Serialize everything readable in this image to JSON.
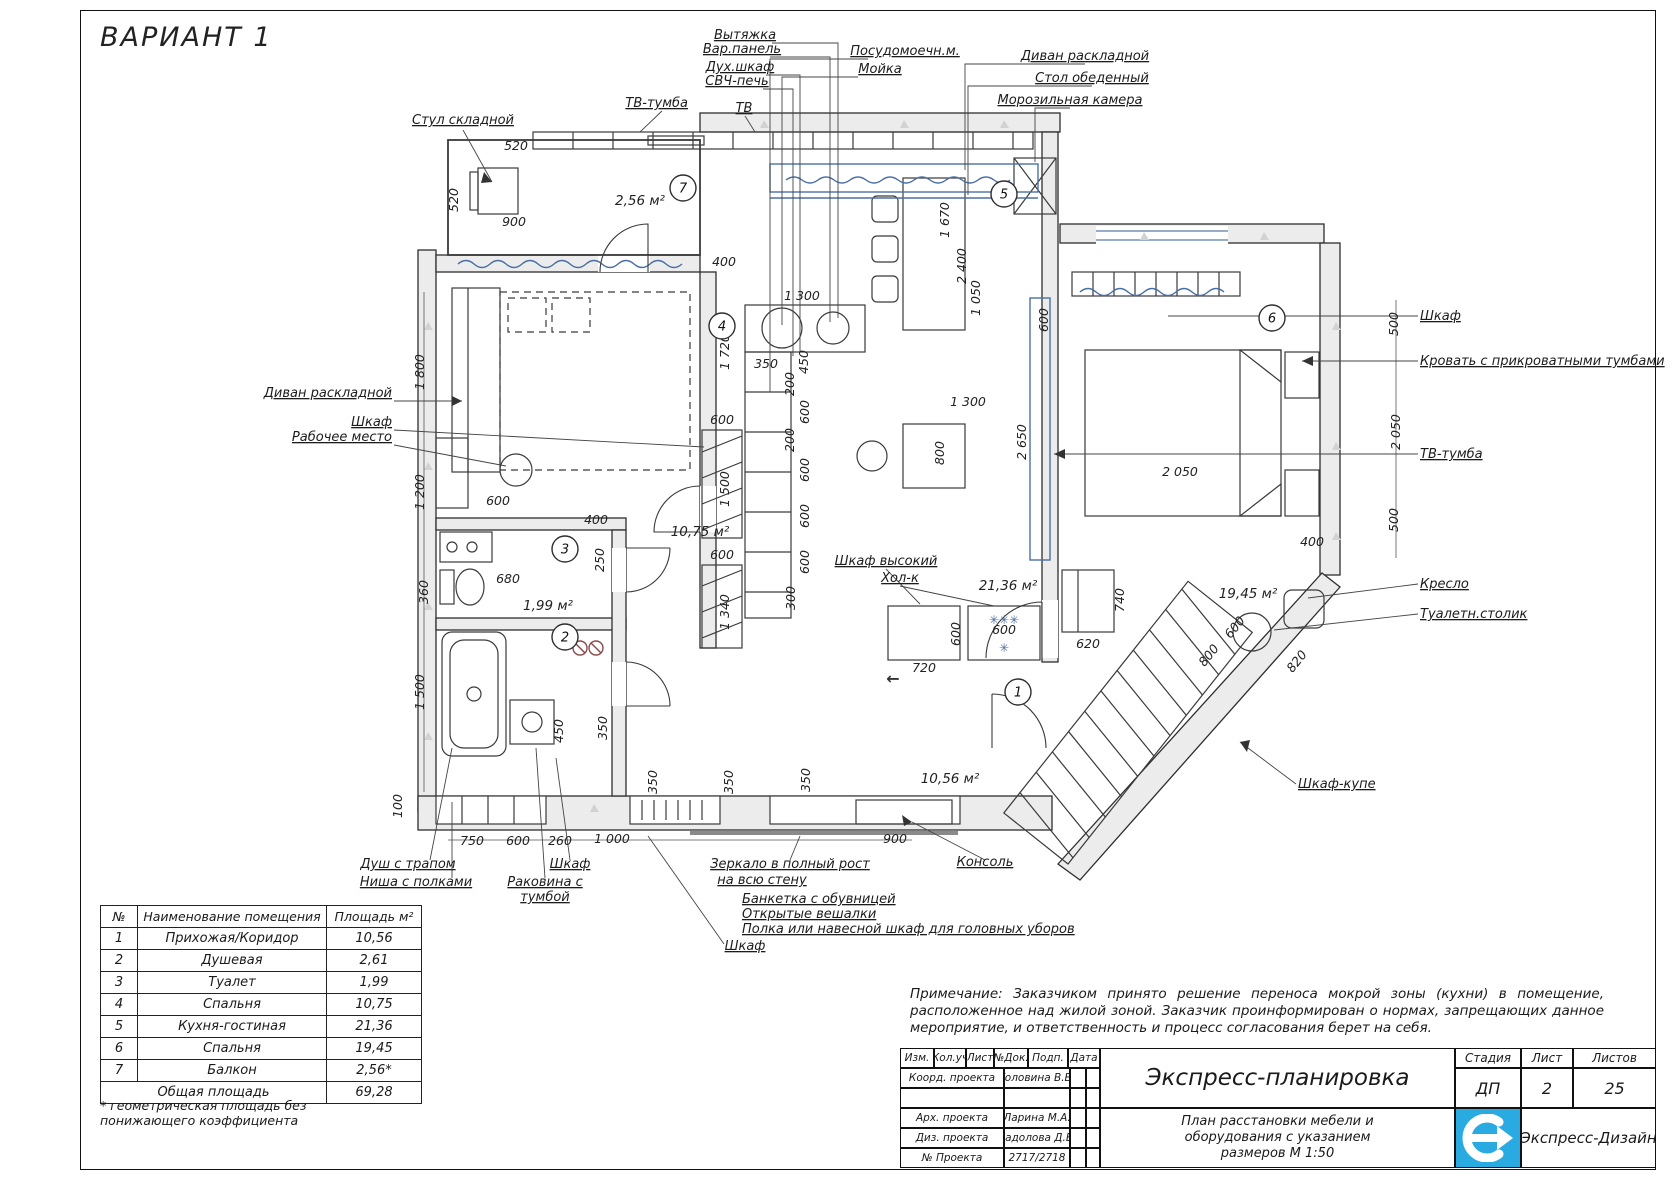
{
  "sheet": {
    "variant_title": "ВАРИАНТ 1"
  },
  "plan": {
    "callouts": [
      {
        "t": "Стул складной",
        "x": 463,
        "y": 124,
        "a": "m"
      },
      {
        "t": "ТВ-тумба",
        "x": 688,
        "y": 107,
        "a": "e"
      },
      {
        "t": "ТВ",
        "x": 744,
        "y": 112,
        "a": "m"
      },
      {
        "t": "Вытяжка",
        "x": 745,
        "y": 39,
        "a": "m"
      },
      {
        "t": "Вар.панель",
        "x": 742,
        "y": 53,
        "a": "m"
      },
      {
        "t": "Дух.шкаф",
        "x": 740,
        "y": 71,
        "a": "m"
      },
      {
        "t": "СВЧ-печь",
        "x": 737,
        "y": 85,
        "a": "m"
      },
      {
        "t": "Посудомоечн.м.",
        "x": 905,
        "y": 55,
        "a": "m"
      },
      {
        "t": "Мойка",
        "x": 880,
        "y": 73,
        "a": "m"
      },
      {
        "t": "Диван раскладной",
        "x": 1085,
        "y": 60,
        "a": "m"
      },
      {
        "t": "Стол обеденный",
        "x": 1092,
        "y": 82,
        "a": "m"
      },
      {
        "t": "Морозильная камера",
        "x": 1070,
        "y": 104,
        "a": "m"
      },
      {
        "t": "Диван раскладной",
        "x": 392,
        "y": 397,
        "a": "e"
      },
      {
        "t": "Шкаф",
        "x": 392,
        "y": 426,
        "a": "e"
      },
      {
        "t": "Рабочее место",
        "x": 392,
        "y": 441,
        "a": "e"
      },
      {
        "t": "Шкаф высокий",
        "x": 886,
        "y": 565,
        "a": "m"
      },
      {
        "t": "Хол-к",
        "x": 900,
        "y": 582,
        "a": "m"
      },
      {
        "t": "Шкаф",
        "x": 1420,
        "y": 320,
        "a": "s"
      },
      {
        "t": "Кровать с прикроватными тумбами",
        "x": 1420,
        "y": 365,
        "a": "s"
      },
      {
        "t": "ТВ-тумба",
        "x": 1420,
        "y": 458,
        "a": "s"
      },
      {
        "t": "Кресло",
        "x": 1420,
        "y": 588,
        "a": "s"
      },
      {
        "t": "Туалетн.столик",
        "x": 1420,
        "y": 618,
        "a": "s"
      },
      {
        "t": "Шкаф-купе",
        "x": 1298,
        "y": 788,
        "a": "s"
      },
      {
        "t": "Душ с трапом",
        "x": 408,
        "y": 868,
        "a": "m"
      },
      {
        "t": "Ниша с полками",
        "x": 416,
        "y": 886,
        "a": "m"
      },
      {
        "t": "Шкаф",
        "x": 570,
        "y": 868,
        "a": "m"
      },
      {
        "t": "Раковина с",
        "x": 545,
        "y": 886,
        "a": "m"
      },
      {
        "t": "тумбой",
        "x": 545,
        "y": 901,
        "a": "m"
      },
      {
        "t": "Зеркало в полный рост",
        "x": 790,
        "y": 868,
        "a": "m"
      },
      {
        "t": "на всю стену",
        "x": 762,
        "y": 884,
        "a": "m"
      },
      {
        "t": "Банкетка с обувницей",
        "x": 742,
        "y": 903,
        "a": "s"
      },
      {
        "t": "Открытые вешалки",
        "x": 742,
        "y": 918,
        "a": "s"
      },
      {
        "t": "Полка или навесной шкаф для головных уборов",
        "x": 742,
        "y": 933,
        "a": "s"
      },
      {
        "t": "Шкаф",
        "x": 745,
        "y": 950,
        "a": "m"
      },
      {
        "t": "Консоль",
        "x": 985,
        "y": 866,
        "a": "m"
      }
    ],
    "dims": [
      {
        "t": "520",
        "x": 516,
        "y": 150,
        "r": 0
      },
      {
        "t": "520",
        "x": 458,
        "y": 200,
        "r": -90
      },
      {
        "t": "900",
        "x": 514,
        "y": 226,
        "r": 0
      },
      {
        "t": "1 800",
        "x": 424,
        "y": 372,
        "r": -90
      },
      {
        "t": "1 200",
        "x": 424,
        "y": 492,
        "r": -90
      },
      {
        "t": "360",
        "x": 428,
        "y": 592,
        "r": -90
      },
      {
        "t": "1 500",
        "x": 424,
        "y": 692,
        "r": -90
      },
      {
        "t": "100",
        "x": 402,
        "y": 806,
        "r": -90
      },
      {
        "t": "600",
        "x": 498,
        "y": 505,
        "r": 0
      },
      {
        "t": "400",
        "x": 596,
        "y": 524,
        "r": 0
      },
      {
        "t": "680",
        "x": 508,
        "y": 583,
        "r": 0
      },
      {
        "t": "250",
        "x": 604,
        "y": 560,
        "r": -90
      },
      {
        "t": "450",
        "x": 563,
        "y": 731,
        "r": -90
      },
      {
        "t": "350",
        "x": 607,
        "y": 728,
        "r": -90
      },
      {
        "t": "400",
        "x": 724,
        "y": 266,
        "r": 0
      },
      {
        "t": "1 720",
        "x": 729,
        "y": 352,
        "r": -90
      },
      {
        "t": "1 300",
        "x": 802,
        "y": 300,
        "r": 0
      },
      {
        "t": "350",
        "x": 766,
        "y": 368,
        "r": 0
      },
      {
        "t": "450",
        "x": 808,
        "y": 362,
        "r": -90
      },
      {
        "t": "200",
        "x": 794,
        "y": 384,
        "r": -90
      },
      {
        "t": "600",
        "x": 809,
        "y": 412,
        "r": -90
      },
      {
        "t": "200",
        "x": 794,
        "y": 440,
        "r": -90
      },
      {
        "t": "600",
        "x": 809,
        "y": 470,
        "r": -90
      },
      {
        "t": "600",
        "x": 809,
        "y": 516,
        "r": -90
      },
      {
        "t": "600",
        "x": 809,
        "y": 562,
        "r": -90
      },
      {
        "t": "300",
        "x": 795,
        "y": 598,
        "r": -90
      },
      {
        "t": "600",
        "x": 722,
        "y": 424,
        "r": 0
      },
      {
        "t": "1 500",
        "x": 729,
        "y": 489,
        "r": -90
      },
      {
        "t": "600",
        "x": 722,
        "y": 559,
        "r": 0
      },
      {
        "t": "1 340",
        "x": 729,
        "y": 612,
        "r": -90
      },
      {
        "t": "1 670",
        "x": 949,
        "y": 220,
        "r": -90
      },
      {
        "t": "2 400",
        "x": 966,
        "y": 266,
        "r": -90
      },
      {
        "t": "1 050",
        "x": 980,
        "y": 298,
        "r": -90
      },
      {
        "t": "1 300",
        "x": 968,
        "y": 406,
        "r": 0
      },
      {
        "t": "800",
        "x": 944,
        "y": 453,
        "r": -90
      },
      {
        "t": "720",
        "x": 924,
        "y": 672,
        "r": 0
      },
      {
        "t": "600",
        "x": 1004,
        "y": 634,
        "r": 0
      },
      {
        "t": "600",
        "x": 960,
        "y": 634,
        "r": -90
      },
      {
        "t": "620",
        "x": 1088,
        "y": 648,
        "r": 0
      },
      {
        "t": "740",
        "x": 1124,
        "y": 600,
        "r": -90
      },
      {
        "t": "600",
        "x": 1048,
        "y": 320,
        "r": -90
      },
      {
        "t": "2 650",
        "x": 1026,
        "y": 442,
        "r": -90
      },
      {
        "t": "2 050",
        "x": 1180,
        "y": 476,
        "r": 0
      },
      {
        "t": "500",
        "x": 1398,
        "y": 324,
        "r": -90
      },
      {
        "t": "2 050",
        "x": 1400,
        "y": 432,
        "r": -90
      },
      {
        "t": "500",
        "x": 1398,
        "y": 520,
        "r": -90
      },
      {
        "t": "400",
        "x": 1312,
        "y": 546,
        "r": 0
      },
      {
        "t": "600",
        "x": 1238,
        "y": 630,
        "r": -51
      },
      {
        "t": "800",
        "x": 1212,
        "y": 658,
        "r": -51
      },
      {
        "t": "820",
        "x": 1300,
        "y": 664,
        "r": -51
      },
      {
        "t": "750",
        "x": 472,
        "y": 845,
        "r": 0
      },
      {
        "t": "600",
        "x": 518,
        "y": 845,
        "r": 0
      },
      {
        "t": "260",
        "x": 560,
        "y": 845,
        "r": 0
      },
      {
        "t": "1 000",
        "x": 612,
        "y": 843,
        "r": 0
      },
      {
        "t": "900",
        "x": 895,
        "y": 843,
        "r": 0
      },
      {
        "t": "350",
        "x": 657,
        "y": 782,
        "r": -90
      },
      {
        "t": "350",
        "x": 733,
        "y": 782,
        "r": -90
      },
      {
        "t": "350",
        "x": 810,
        "y": 780,
        "r": -90
      }
    ],
    "areas": [
      {
        "t": "2,56 м²",
        "x": 640,
        "y": 205
      },
      {
        "t": "10,75 м²",
        "x": 700,
        "y": 536
      },
      {
        "t": "1,99 м²",
        "x": 548,
        "y": 610
      },
      {
        "t": "21,36 м²",
        "x": 1008,
        "y": 590
      },
      {
        "t": "19,45 м²",
        "x": 1248,
        "y": 598
      },
      {
        "t": "10,56 м²",
        "x": 950,
        "y": 783
      }
    ],
    "markers": [
      {
        "n": "7",
        "x": 683,
        "y": 188
      },
      {
        "n": "4",
        "x": 722,
        "y": 326
      },
      {
        "n": "3",
        "x": 565,
        "y": 549
      },
      {
        "n": "2",
        "x": 565,
        "y": 637
      },
      {
        "n": "5",
        "x": 1004,
        "y": 194
      },
      {
        "n": "6",
        "x": 1272,
        "y": 318
      },
      {
        "n": "1",
        "x": 1018,
        "y": 692
      }
    ],
    "symbols": [
      {
        "t": "✳✳✳",
        "x": 1004,
        "y": 624,
        "c": "#4a6fa5",
        "s": 12
      },
      {
        "t": "✳",
        "x": 1004,
        "y": 652,
        "c": "#4a6fa5",
        "s": 12
      },
      {
        "t": "←",
        "x": 893,
        "y": 684,
        "c": "#333",
        "s": 16
      }
    ]
  },
  "rooms_table": {
    "headers": [
      "№",
      "Наименование помещения",
      "Площадь м²"
    ],
    "rows": [
      [
        "1",
        "Прихожая/Коридор",
        "10,56"
      ],
      [
        "2",
        "Душевая",
        "2,61"
      ],
      [
        "3",
        "Туалет",
        "1,99"
      ],
      [
        "4",
        "Спальня",
        "10,75"
      ],
      [
        "5",
        "Кухня-гостиная",
        "21,36"
      ],
      [
        "6",
        "Спальня",
        "19,45"
      ],
      [
        "7",
        "Балкон",
        "2,56*"
      ]
    ],
    "total_label": "Общая площадь",
    "total_value": "69,28",
    "footnote": "* геометрическая площадь без понижающего коэффициента"
  },
  "note": {
    "text": "Примечание: Заказчиком принято решение переноса мокрой зоны (кухни) в помещение, расположенное над жилой зоной. Заказчик проинформирован о нормах, запрещающих данное мероприятие, и ответственность и процесс согласования берет на себя."
  },
  "title_block": {
    "header_cells": [
      "Изм.",
      "Кол.уч",
      "Лист",
      "№Док.",
      "Подп.",
      "Дата"
    ],
    "rows": [
      [
        "Коорд. проекта",
        "Головина В.В."
      ],
      [
        "",
        ""
      ],
      [
        "Арх. проекта",
        "Ларина М.А."
      ],
      [
        "Диз. проекта",
        "Кадолова Д.В."
      ],
      [
        "№ Проекта",
        "2717/2718"
      ]
    ],
    "project_title": "Экспресс-планировка",
    "stage_label": "Стадия",
    "sheet_label": "Лист",
    "sheets_label": "Листов",
    "stage": "ДП",
    "sheet": "2",
    "sheets": "25",
    "drawing_title": "План расстановки мебели и\nоборудования с указанием\nразмеров М 1:50",
    "company": "Экспресс-Дизайн",
    "logo_color": "#29abe2"
  }
}
